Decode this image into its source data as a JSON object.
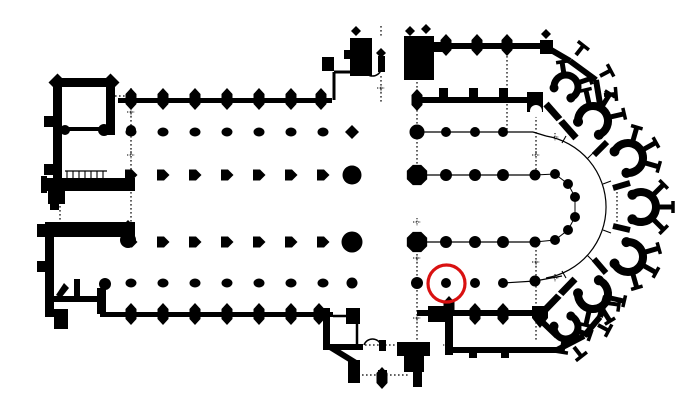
{
  "canvas": {
    "width": 700,
    "height": 414
  },
  "colors": {
    "ink": "#000000",
    "background": "#ffffff",
    "highlight": "#d91111"
  },
  "annotation": {
    "highlight_circle": {
      "cx": 446.5,
      "cy": 283.5,
      "r": 18.5,
      "stroke_width": 3.2
    }
  },
  "plan": {
    "column_grid": {
      "xs": [
        131,
        163,
        195,
        227,
        259,
        291,
        323
      ],
      "rows": [
        {
          "y": 132,
          "shape": "oval"
        },
        {
          "y": 175,
          "shape": "pent"
        },
        {
          "y": 242,
          "shape": "pent"
        },
        {
          "y": 283,
          "shape": "oval"
        }
      ]
    },
    "extra_dots": [
      [
        352,
        175,
        9.5
      ],
      [
        352,
        242,
        10.5
      ],
      [
        352,
        283,
        5.5
      ],
      [
        417,
        132,
        7.5
      ],
      [
        417,
        283,
        6
      ],
      [
        446,
        132,
        5
      ],
      [
        475,
        132,
        5
      ],
      [
        503,
        132,
        5
      ],
      [
        446,
        175,
        6
      ],
      [
        475,
        175,
        6
      ],
      [
        503,
        175,
        6
      ],
      [
        535,
        175,
        5.5
      ],
      [
        446,
        242,
        6
      ],
      [
        475,
        242,
        6
      ],
      [
        503,
        242,
        6
      ],
      [
        535,
        242,
        5.5
      ],
      [
        446,
        283,
        5
      ],
      [
        475,
        283,
        5
      ],
      [
        503,
        283,
        5
      ],
      [
        535,
        281,
        5.5
      ],
      [
        555,
        174,
        5
      ],
      [
        568,
        184,
        5
      ],
      [
        575,
        197,
        5
      ],
      [
        575,
        217,
        5
      ],
      [
        568,
        230,
        5
      ],
      [
        555,
        240,
        5
      ],
      [
        65,
        130,
        5
      ],
      [
        104,
        130,
        6
      ],
      [
        131,
        130,
        5
      ],
      [
        128,
        240,
        8
      ],
      [
        105,
        284,
        6
      ]
    ],
    "walls": [
      [
        53,
        78,
        62,
        9
      ],
      [
        53,
        78,
        9,
        58
      ],
      [
        106,
        78,
        9,
        57
      ],
      [
        44,
        116,
        9,
        11
      ],
      [
        62,
        127,
        44,
        4
      ],
      [
        53,
        136,
        9,
        44
      ],
      [
        44,
        164,
        9,
        11
      ],
      [
        45,
        178,
        90,
        13
      ],
      [
        41,
        176,
        6,
        17
      ],
      [
        48,
        191,
        17,
        13
      ],
      [
        50,
        204,
        9,
        6
      ],
      [
        45,
        222,
        90,
        15
      ],
      [
        37,
        224,
        9,
        13
      ],
      [
        45,
        237,
        9,
        60
      ],
      [
        37,
        261,
        9,
        11
      ],
      [
        74,
        279,
        6,
        18
      ],
      [
        53,
        296,
        52,
        6
      ],
      [
        45,
        297,
        9,
        14
      ],
      [
        97,
        288,
        9,
        26
      ],
      [
        54,
        309,
        14,
        20
      ],
      [
        45,
        305,
        9,
        12
      ],
      [
        118,
        98,
        214,
        5
      ],
      [
        100,
        312,
        233,
        5
      ],
      [
        417,
        97,
        118,
        6
      ],
      [
        527,
        92,
        16,
        20
      ],
      [
        417,
        310,
        116,
        6
      ],
      [
        428,
        306,
        20,
        16
      ],
      [
        439,
        88,
        9,
        9
      ],
      [
        469,
        88,
        9,
        9
      ],
      [
        499,
        88,
        9,
        9
      ],
      [
        350,
        38,
        22,
        38
      ],
      [
        344,
        50,
        8,
        9
      ],
      [
        404,
        36,
        30,
        44
      ],
      [
        434,
        42,
        10,
        10
      ],
      [
        378,
        56,
        7,
        16
      ],
      [
        432,
        43,
        113,
        6
      ],
      [
        540,
        40,
        13,
        14
      ],
      [
        322,
        57,
        12,
        14
      ],
      [
        323,
        308,
        7,
        42
      ],
      [
        323,
        344,
        40,
        6
      ],
      [
        346,
        308,
        14,
        16
      ],
      [
        397,
        342,
        33,
        14
      ],
      [
        404,
        356,
        20,
        16
      ],
      [
        413,
        370,
        9,
        17
      ],
      [
        445,
        310,
        8,
        45
      ],
      [
        453,
        347,
        104,
        6
      ],
      [
        348,
        360,
        12,
        23
      ],
      [
        379,
        340,
        7,
        11
      ],
      [
        378,
        370,
        9,
        12
      ],
      [
        469,
        352,
        8,
        6
      ],
      [
        501,
        352,
        8,
        6
      ],
      [
        536,
        347,
        8,
        6
      ]
    ],
    "lines": [
      [
        546,
        47,
        570,
        61,
        6
      ],
      [
        570,
        61,
        596,
        80,
        6
      ],
      [
        596,
        80,
        601,
        110,
        6
      ],
      [
        546,
        104,
        576,
        138,
        7
      ],
      [
        557,
        350,
        584,
        336,
        6
      ],
      [
        584,
        336,
        600,
        317,
        6
      ],
      [
        600,
        317,
        606,
        296,
        6
      ],
      [
        545,
        310,
        575,
        279,
        7
      ],
      [
        330,
        347,
        356,
        363,
        6
      ],
      [
        533,
        313,
        557,
        336,
        6
      ],
      [
        594,
        155,
        607,
        142,
        6
      ],
      [
        613,
        188,
        630,
        183,
        6
      ],
      [
        613,
        226,
        630,
        230,
        6
      ],
      [
        594,
        259,
        606,
        273,
        6
      ],
      [
        334,
        72,
        334,
        100,
        3
      ],
      [
        334,
        72,
        352,
        72,
        3
      ],
      [
        333,
        316,
        357,
        316,
        2.5
      ],
      [
        357,
        316,
        357,
        344,
        2.5
      ]
    ],
    "tbuts": [
      [
        576,
        55,
        -52
      ],
      [
        600,
        76,
        -28
      ],
      [
        604,
        95,
        -5
      ],
      [
        574,
        347,
        52
      ],
      [
        598,
        325,
        28
      ],
      [
        607,
        303,
        8
      ]
    ],
    "thin_lines": [
      [
        417,
        132,
        533,
        132
      ],
      [
        417,
        175,
        535,
        175
      ],
      [
        417,
        242,
        535,
        242
      ],
      [
        503,
        283,
        535,
        281
      ],
      [
        535,
        281,
        562,
        276
      ],
      [
        533,
        132,
        546,
        136
      ],
      [
        65,
        171,
        107,
        171
      ]
    ],
    "stair_ticks": [
      [
        67,
        171,
        67,
        179
      ],
      [
        73,
        171,
        73,
        179
      ],
      [
        79,
        171,
        79,
        179
      ],
      [
        85,
        171,
        85,
        179
      ],
      [
        91,
        171,
        91,
        179
      ],
      [
        97,
        171,
        97,
        179
      ],
      [
        103,
        171,
        103,
        179
      ]
    ],
    "arc_ticks": [
      [
        562,
        143,
        566,
        136
      ],
      [
        587,
        159,
        593,
        153
      ],
      [
        603,
        184,
        611,
        181
      ],
      [
        603,
        230,
        611,
        233
      ],
      [
        587,
        255,
        593,
        261
      ],
      [
        562,
        271,
        566,
        278
      ]
    ],
    "polylines": [
      {
        "points": [
          [
            535,
            175
          ],
          [
            555,
            174
          ],
          [
            568,
            184
          ],
          [
            575,
            197
          ],
          [
            575,
            217
          ],
          [
            568,
            230
          ],
          [
            555,
            240
          ],
          [
            535,
            242
          ]
        ],
        "w": 1
      }
    ],
    "arcs": [
      {
        "d": "M 546 136 A 72 72 0 0 1 546 278",
        "w": 1.2
      },
      {
        "d": "M 364 70 A 9 9 0 0 0 381 70",
        "w": 1.5
      },
      {
        "d": "M 364 345 A 9 9 0 0 1 381 345",
        "w": 1.5
      }
    ],
    "hex_buttresses": [
      [
        131,
        99
      ],
      [
        163,
        99
      ],
      [
        195,
        99
      ],
      [
        227,
        99
      ],
      [
        259,
        99
      ],
      [
        291,
        99
      ],
      [
        321,
        99
      ],
      [
        131,
        314
      ],
      [
        163,
        314
      ],
      [
        195,
        314
      ],
      [
        227,
        314
      ],
      [
        259,
        314
      ],
      [
        291,
        314
      ],
      [
        319,
        314
      ],
      [
        417,
        100
      ],
      [
        446,
        45
      ],
      [
        477,
        45
      ],
      [
        507,
        45
      ],
      [
        475,
        314
      ],
      [
        503,
        314
      ],
      [
        449,
        307
      ],
      [
        382,
        378
      ]
    ],
    "diamonds": [
      [
        57.5,
        82.5,
        9
      ],
      [
        110.5,
        82.5,
        9
      ],
      [
        352,
        132,
        7
      ],
      [
        128,
        226,
        6
      ],
      [
        381,
        53,
        5
      ],
      [
        410,
        31,
        5
      ],
      [
        426,
        29,
        5
      ],
      [
        356,
        31,
        5
      ],
      [
        546,
        34,
        5
      ]
    ],
    "octagons": [
      [
        417,
        175,
        11
      ],
      [
        417,
        242,
        11
      ]
    ],
    "pent_down": [
      [
        540,
        316
      ]
    ],
    "stair_arrow": [
      [
        56,
        295
      ],
      [
        64,
        283
      ],
      [
        69,
        288
      ],
      [
        61,
        298
      ]
    ],
    "chapels": [
      {
        "cx": 593,
        "cy": 121,
        "rot": -58,
        "r": 15,
        "sw": 8,
        "spokes": [
          -45,
          0,
          45
        ],
        "len": 13
      },
      {
        "cx": 628,
        "cy": 158,
        "rot": -29,
        "r": 15,
        "sw": 8,
        "spokes": [
          -45,
          0,
          45
        ],
        "len": 13
      },
      {
        "cx": 641,
        "cy": 207,
        "rot": 0,
        "r": 15,
        "sw": 8,
        "spokes": [
          -45,
          0,
          45
        ],
        "len": 13
      },
      {
        "cx": 628,
        "cy": 257,
        "rot": 29,
        "r": 15,
        "sw": 8,
        "spokes": [
          -45,
          0,
          45
        ],
        "len": 13
      },
      {
        "cx": 593,
        "cy": 294,
        "rot": 58,
        "r": 15,
        "sw": 8,
        "spokes": [
          -45,
          0,
          45
        ],
        "len": 13
      },
      {
        "cx": 566,
        "cy": 87,
        "rot": -59,
        "r": 12,
        "sw": 7,
        "spokes": [
          -40,
          40
        ],
        "len": 10
      },
      {
        "cx": 566,
        "cy": 327,
        "rot": 59,
        "r": 12,
        "sw": 7,
        "spokes": [
          -40,
          40
        ],
        "len": 10
      }
    ],
    "white_marks": [
      [
        555,
        124,
        566,
        116,
        2.5
      ],
      [
        555,
        291,
        565,
        299,
        2.5
      ]
    ],
    "white_dots": [
      [
        536,
        111,
        6
      ]
    ],
    "dotted": [
      [
        131,
        88,
        131,
        222
      ],
      [
        60,
        198,
        60,
        222
      ],
      [
        381,
        26,
        381,
        38
      ],
      [
        381,
        76,
        381,
        102
      ],
      [
        417,
        78,
        417,
        170
      ],
      [
        417,
        246,
        417,
        342
      ],
      [
        507,
        48,
        507,
        132
      ],
      [
        536,
        112,
        536,
        170
      ],
      [
        536,
        246,
        536,
        342
      ],
      [
        617,
        188,
        617,
        228
      ],
      [
        353,
        345,
        400,
        345
      ],
      [
        358,
        375,
        408,
        375
      ],
      [
        115,
        96,
        127,
        96
      ]
    ],
    "crosses": [
      [
        131,
        112
      ],
      [
        131,
        155
      ],
      [
        417,
        100
      ],
      [
        417,
        133
      ],
      [
        417,
        222
      ],
      [
        417,
        258
      ],
      [
        417,
        318
      ],
      [
        381,
        88
      ],
      [
        536,
        155
      ],
      [
        536,
        262
      ],
      [
        555,
        278
      ],
      [
        555,
        137
      ],
      [
        447,
        345
      ]
    ]
  }
}
